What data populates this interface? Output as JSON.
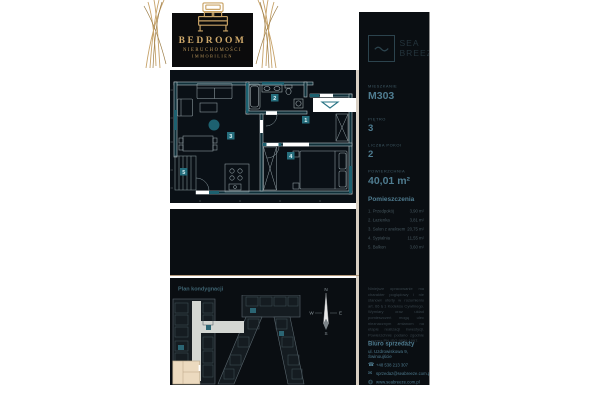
{
  "brand": {
    "title": "BEDROOM",
    "subtitle1": "NIERUCHOMOŚCI",
    "subtitle2": "IMMOBILIEN"
  },
  "project": {
    "name_line1": "SEA",
    "name_line2": "BREEZE"
  },
  "unit": {
    "fields": [
      {
        "label": "MIESZKANIE",
        "value": "M303"
      },
      {
        "label": "PIĘTRO",
        "value": "3"
      },
      {
        "label": "LICZBA POKOI",
        "value": "2"
      },
      {
        "label": "POWIERZCHNIA",
        "value": "40,01 m²"
      }
    ]
  },
  "rooms": {
    "title": "Pomieszczenia",
    "items": [
      {
        "name": "1. Przedpokój",
        "area": "3,90 m²"
      },
      {
        "name": "2. Łazienka",
        "area": "3,81 m²"
      },
      {
        "name": "3. Salon z aneksem",
        "area": "20,75 m²"
      },
      {
        "name": "4. Sypialnia",
        "area": "11,55 m²"
      },
      {
        "name": "5. Balkon",
        "area": "3,60 m²"
      }
    ]
  },
  "floor_plan": {
    "badges": [
      "1",
      "2",
      "3",
      "4",
      "5"
    ]
  },
  "site_plan": {
    "title": "Plan kondygnacji",
    "compass": {
      "n": "N",
      "e": "E",
      "s": "S",
      "w": "W"
    }
  },
  "legal": {
    "text": "Niniejsze opracowanie ma charakter poglądowy i nie stanowi oferty w rozumieniu art. 66 § 1 Kodeksu Cywilnego. Wymiary oraz układ pomieszczeń mogą ulec nieznacznym zmianom na etapie realizacji inwestycji. Powierzchnie podano zgodnie z normą PN-ISO 9836:1997."
  },
  "contact": {
    "title": "Biuro sprzedaży",
    "address": "ul. Uzdrowiskowa 9, Świnoujście",
    "phone": "+48 538 213 307",
    "email": "sprzedaz@seabreeze.com.pl",
    "website": "www.seabreeze.com.pl"
  },
  "icons": {
    "phone_glyph": "☎",
    "email_glyph": "✉"
  },
  "colors": {
    "gold": "#b3987a",
    "teal_accent": "#2a7485",
    "value_text": "#4f7c90",
    "highlight_unit": "#ecdabf",
    "dark_bg": "#0a0e12"
  }
}
